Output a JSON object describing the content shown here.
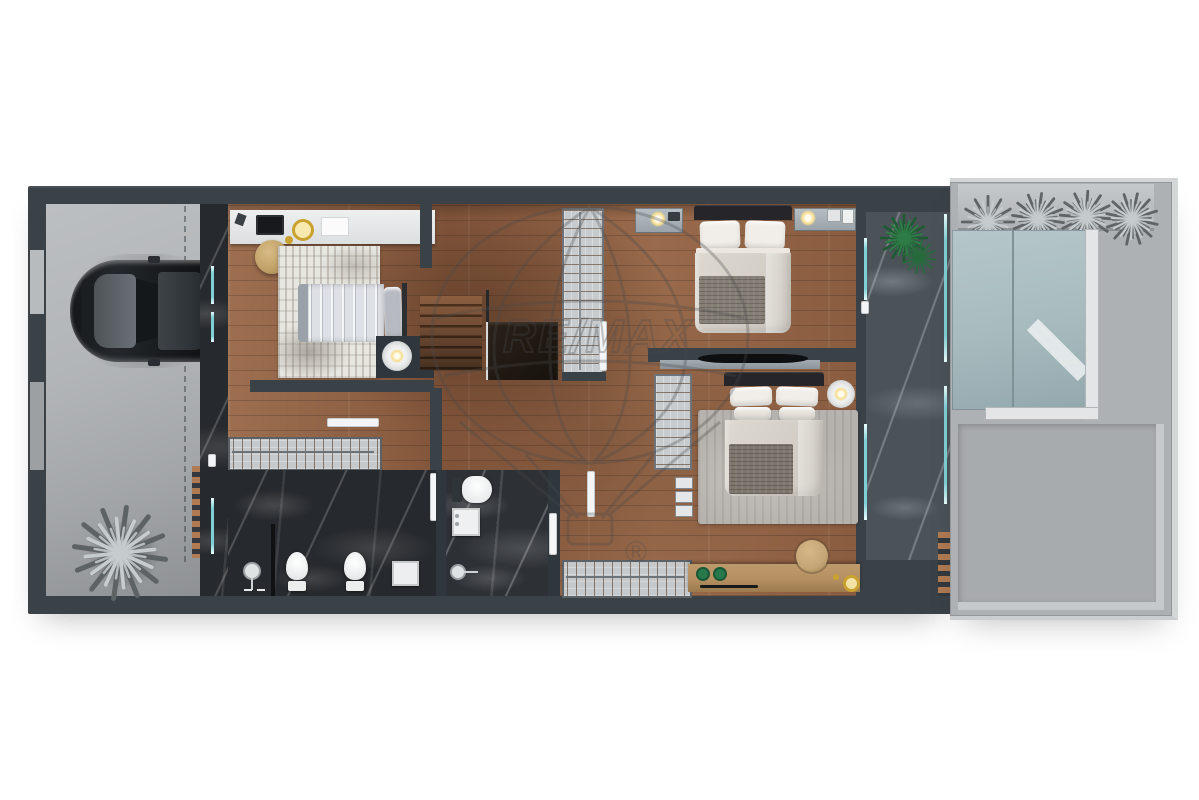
{
  "watermark": {
    "brand": "RE/MAX",
    "registered": "®"
  },
  "colors": {
    "wall": "#3a4147",
    "wall-dark": "#2f363c",
    "garage": "#b2b5b7",
    "wood": "#966748",
    "marble-dark": "#26292d",
    "marble-balcony": "#4b5359",
    "terrace": "#aeb1b3",
    "skylight": "#a7bbbf",
    "glass-teal": "#7fd0d6",
    "rug-light": "#e8e6e1",
    "rug-gray": "#b6b2ad",
    "bedding": "#efece7",
    "throw-gray": "#847e75",
    "furniture-wood": "#b48f62",
    "accent-green": "#27794b",
    "accent-gold": "#c9a12e",
    "plant-green": "#2f7d46",
    "plant-silver": "#c6cbcd",
    "watermark-gray": "#4a4a4a"
  }
}
